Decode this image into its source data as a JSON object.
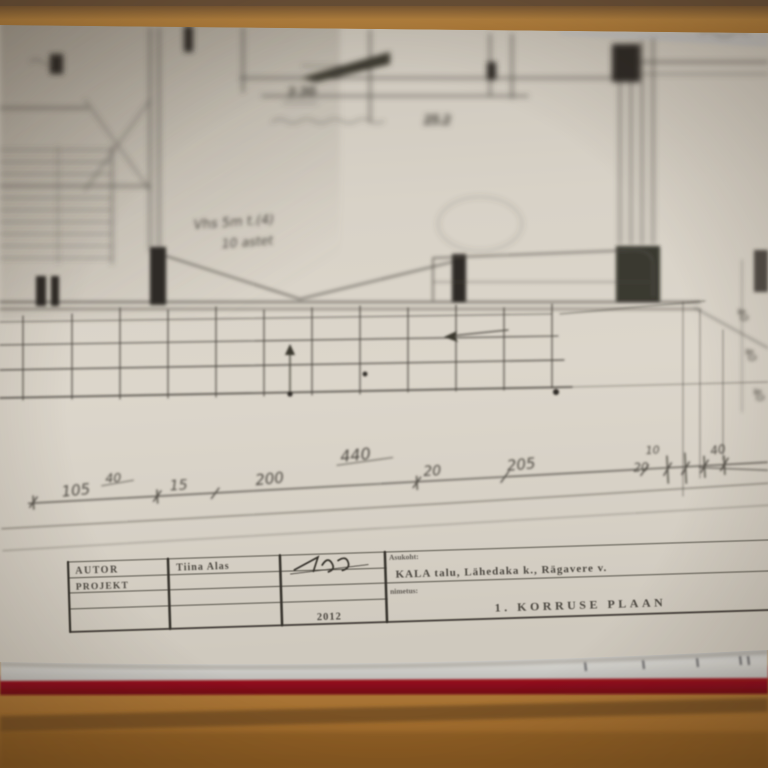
{
  "scene": {
    "description": "Photograph of a hand-drawn architectural first-floor plan on paper, lying on a stack of sheets with a red folder beneath, on a wooden table; shallow depth of field blurs the upper part of the drawing.",
    "colors": {
      "table_wood": "#b27d3c",
      "table_groove": "#6f4c20",
      "paper": "#d9d3c8",
      "pencil": "#4d4942",
      "pencil_dark": "#2e2b25",
      "red_folder": "#96121f",
      "sheet_edge_blue": "#8f99ad"
    }
  },
  "blueprint": {
    "plan_annotations": {
      "top_note": "2.20",
      "top_note_2": "25.2",
      "stair_note": "Vhs 5m t.(4)",
      "stair_note_2": "10 astet"
    },
    "dimension_line": {
      "above_values": [
        "40",
        "440",
        "10",
        "40"
      ],
      "segment_values": [
        "105",
        "15",
        "200",
        "20",
        "205",
        "20"
      ],
      "margin_values": [
        "40",
        "40",
        "40"
      ]
    },
    "title_block": {
      "author_label": "AUTOR",
      "project_label": "PROJEKT",
      "author_name": "Tiina Alas",
      "year": "2012",
      "location_label": "Asukoht:",
      "location_value": "KALA talu, Lähedaka k., Rägavere v.",
      "name_label": "nimetus:",
      "drawing_title": "1. KORRUSE PLAAN"
    }
  }
}
